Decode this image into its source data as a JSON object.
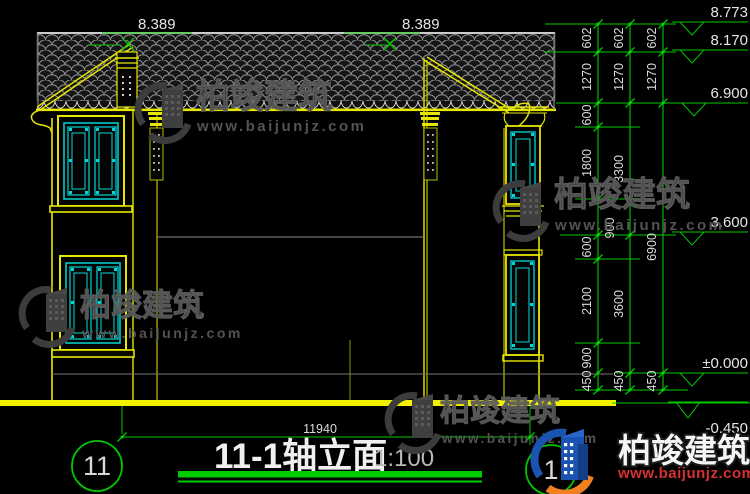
{
  "title": {
    "text": "11-1轴立面",
    "scale": "1:100"
  },
  "drawing": {
    "ridge_dim_left": "8.389",
    "ridge_dim_right": "8.389",
    "total_width_dim": "11940",
    "grid_bubble_left": "11",
    "grid_bubble_right": "1"
  },
  "elevation_markers": [
    {
      "value": "8.773"
    },
    {
      "value": "8.170"
    },
    {
      "value": "6.900"
    },
    {
      "value": "3.600"
    },
    {
      "value": "±0.000"
    },
    {
      "value": "-0.450"
    }
  ],
  "dim_chains": {
    "inner": [
      "602",
      "1270",
      "600",
      "1800",
      "900",
      "600",
      "2100",
      "900",
      "450"
    ],
    "middle": [
      "602",
      "1270",
      "3300",
      "3600",
      "450"
    ],
    "outer": [
      "602",
      "1270",
      "6900",
      "450"
    ]
  },
  "watermark": {
    "name": "柏竣建筑",
    "url": "www.baijunjz.com"
  },
  "colors": {
    "line_green": "#00c800",
    "line_yellow": "#e6e600",
    "glass_cyan": "#00d8d8",
    "text_white": "#e0e0e0",
    "brand_red": "#d83030",
    "brand_blue": "#1a54b0",
    "brand_orange": "#f08020"
  }
}
